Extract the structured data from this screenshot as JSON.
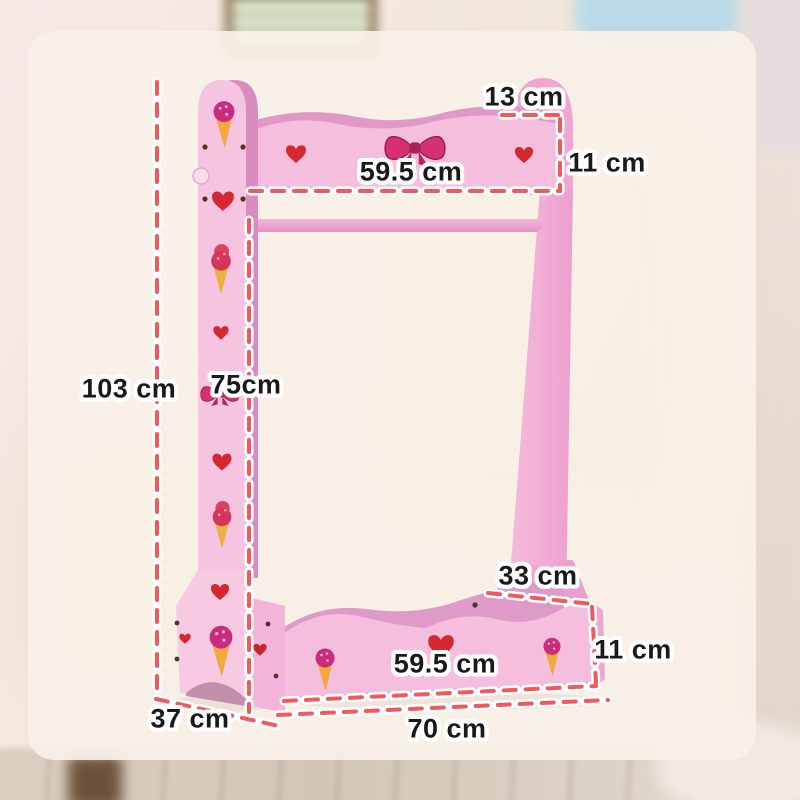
{
  "dimension_labels": {
    "top_depth": "13 cm",
    "top_rail_height": "11 cm",
    "top_rail_width": "59.5 cm",
    "overall_height": "103 cm",
    "hanging_clearance": "75cm",
    "base_top_depth": "33 cm",
    "base_height": "11 cm",
    "base_inner_width": "59.5 cm",
    "overall_depth": "37 cm",
    "overall_width": "70 cm"
  },
  "colors": {
    "rack_pink": "#f1acd4",
    "rack_pink_light": "#f4bedc",
    "rack_pink_dark": "#db8cbf",
    "rack_interior_pink": "#de9ac8",
    "dash_red": "#f2595c",
    "heart_red": "#d62731",
    "bow_pink": "#d5306f",
    "cone_yellow": "#f1a93e",
    "label_text": "#191919",
    "label_outline": "#ffffff",
    "card_background": "#f9f1e7"
  },
  "decoration_icons": [
    "heart-icon",
    "bow-icon",
    "ice-cream-icon",
    "hook-peg-icon",
    "screw-dot-icon"
  ]
}
